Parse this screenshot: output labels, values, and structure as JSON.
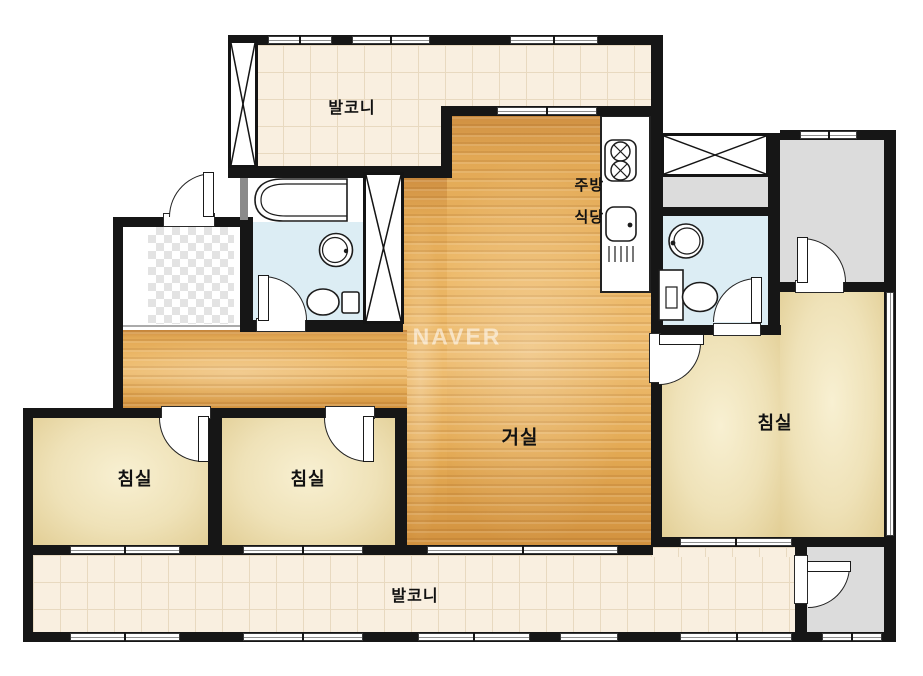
{
  "watermark": "NAVER",
  "rooms": {
    "balcony_top": {
      "label": "발코니"
    },
    "kitchen": {
      "label_line1": "주방",
      "label_line2": "식당"
    },
    "living": {
      "label": "거실"
    },
    "bedroom_left": {
      "label": "침실"
    },
    "bedroom_center": {
      "label": "침실"
    },
    "bedroom_right": {
      "label": "침실"
    },
    "balcony_bottom": {
      "label": "발코니"
    }
  },
  "legend": {
    "fixtures": [
      "bathtub",
      "wash-basin",
      "toilet",
      "stove-burners",
      "kitchen-sink",
      "duct-shaft-x",
      "door-swing",
      "window"
    ]
  },
  "colors": {
    "wall": "#161616",
    "wood_floor": "#e8b05c",
    "bedroom_floor": "#eee1b6",
    "bathroom_floor": "#dcedf4",
    "balcony_tile": "#f9efe0",
    "entry_gray": "#dcdcdc",
    "watermark_color": "rgba(255,255,255,0.55)"
  }
}
